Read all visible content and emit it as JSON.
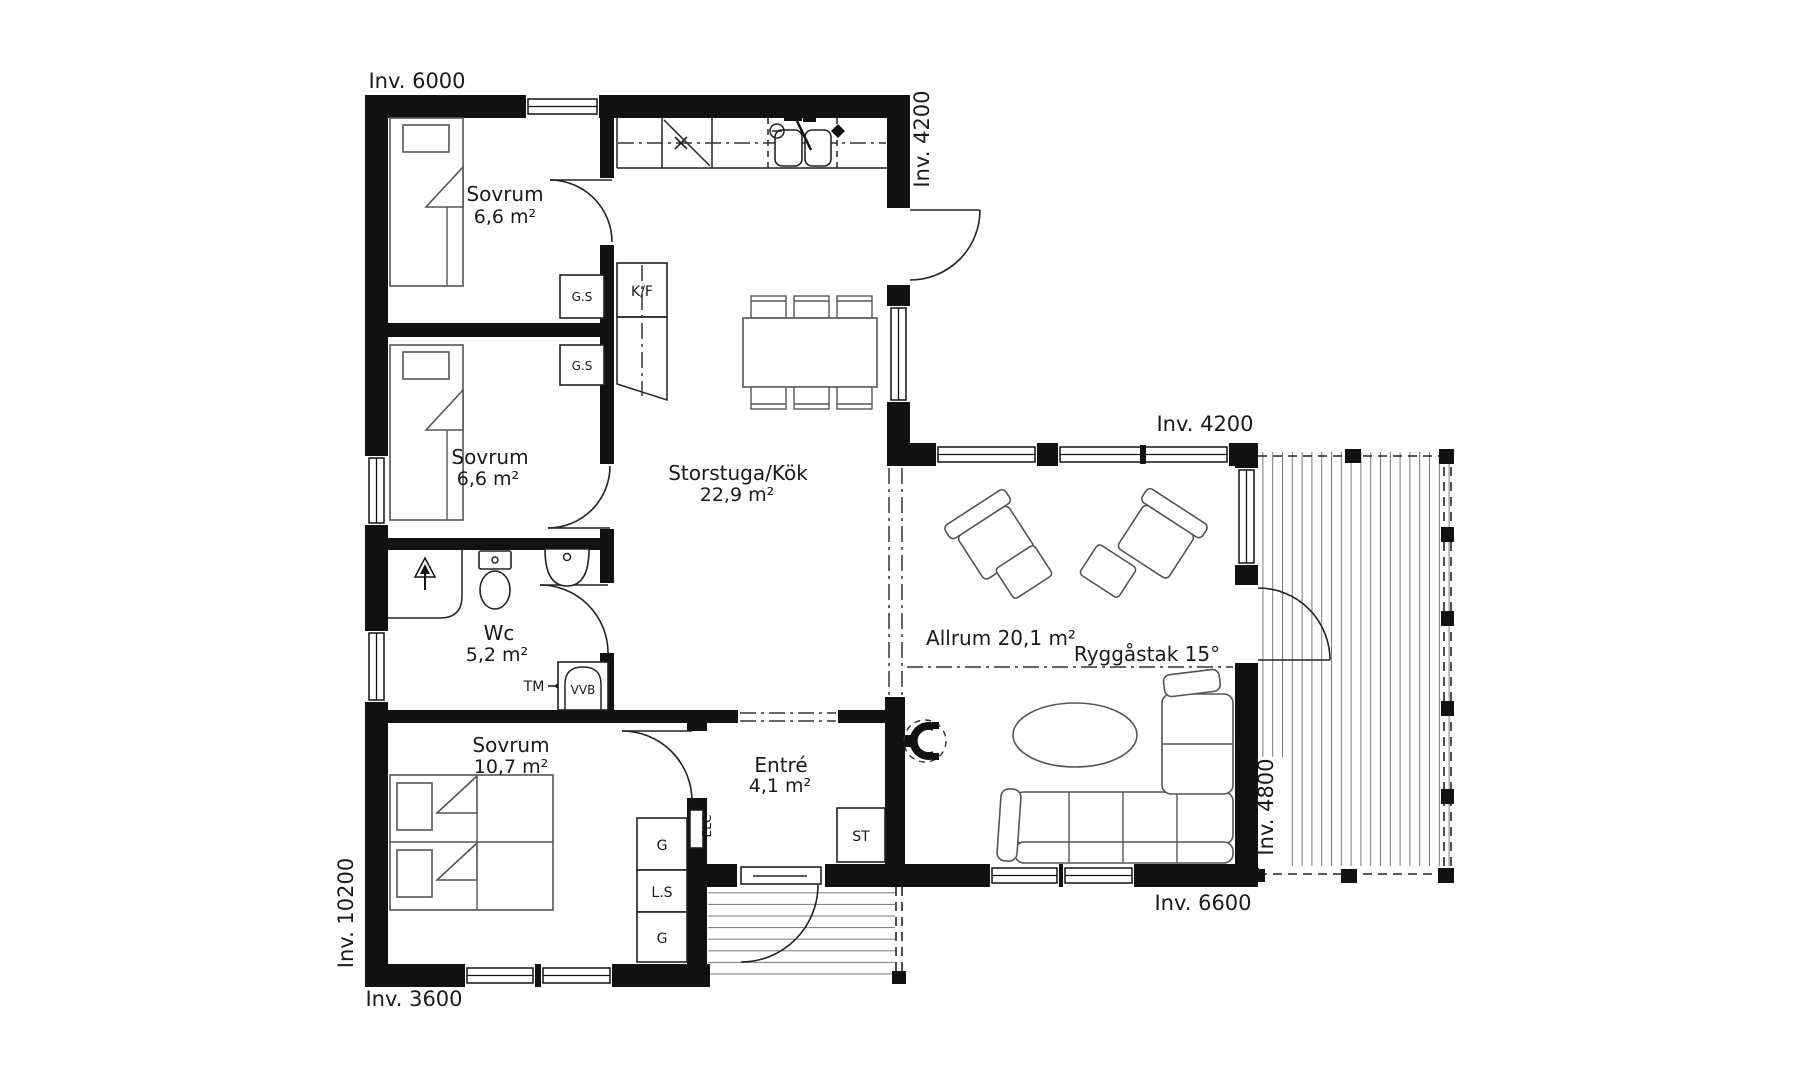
{
  "drawing": {
    "rooms": {
      "sovrum1": {
        "name": "Sovrum",
        "area": "6,6 m²"
      },
      "sovrum2": {
        "name": "Sovrum",
        "area": "6,6 m²"
      },
      "wc": {
        "name": "Wc",
        "area": "5,2 m²"
      },
      "sovrum3": {
        "name": "Sovrum",
        "area": "10,7 m²"
      },
      "storstuga": {
        "name": "Storstuga/Kök",
        "area": "22,9 m²"
      },
      "entre": {
        "name": "Entré",
        "area": "4,1 m²"
      },
      "allrum": {
        "label": "Allrum 20,1 m²"
      }
    },
    "annotations": {
      "ridge": "Ryggåstak 15°"
    },
    "dims": {
      "top": "Inv. 6000",
      "ne": "Inv. 4200",
      "allrum_top": "Inv. 4200",
      "left": "Inv. 10200",
      "bottom_left": "Inv. 3600",
      "deck": "Inv. 4800",
      "bottom_right": "Inv. 6600"
    },
    "fixtures": {
      "gs": "G.S",
      "kf": "K/F",
      "tm": "TM",
      "vvb": "VVB",
      "g": "G",
      "ls": "L.S",
      "st": "ST",
      "elc": "ELC"
    },
    "colors": {
      "wall": "#111111",
      "line": "#555555",
      "text": "#1a1a1a"
    }
  }
}
